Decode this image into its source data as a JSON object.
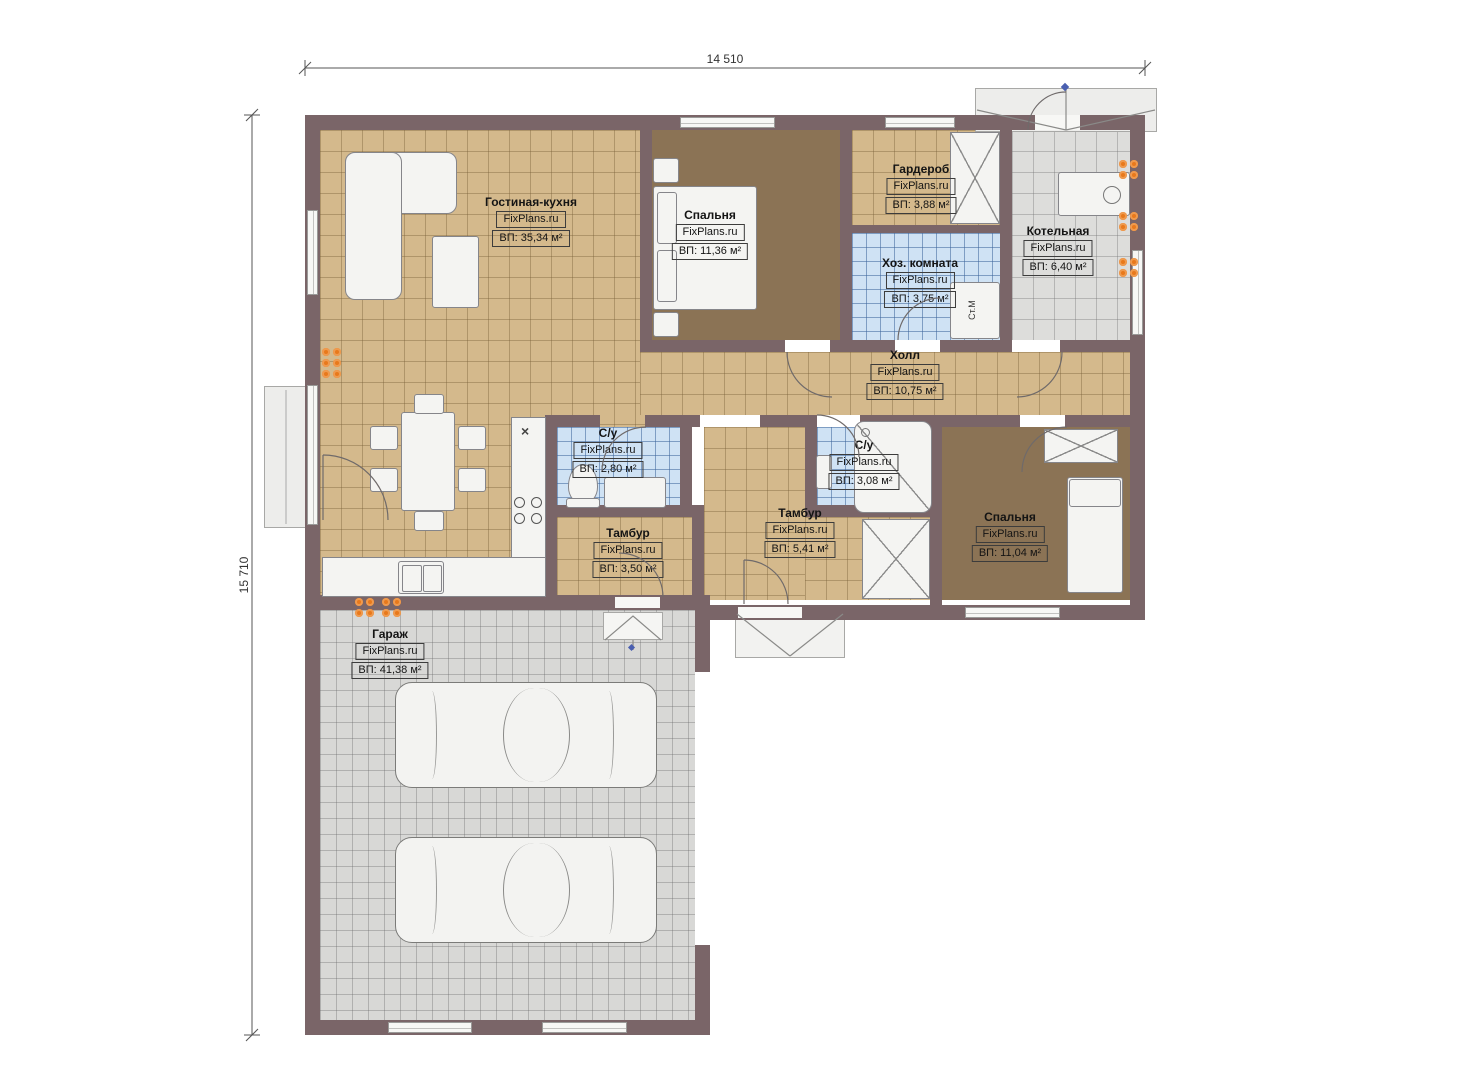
{
  "dimensions": {
    "width_label": "14 510",
    "height_label": "15 710"
  },
  "brand": "FixPlans.ru",
  "rooms": [
    {
      "name": "Гостиная-кухня",
      "brand": "FixPlans.ru",
      "area": "ВП: 35,34 м²"
    },
    {
      "name": "Спальня",
      "brand": "FixPlans.ru",
      "area": "ВП: 11,36 м²"
    },
    {
      "name": "Гардероб",
      "brand": "FixPlans.ru",
      "area": "ВП: 3,88 м²"
    },
    {
      "name": "Хоз. комната",
      "brand": "FixPlans.ru",
      "area": "ВП: 3,75 м²"
    },
    {
      "name": "Котельная",
      "brand": "FixPlans.ru",
      "area": "ВП: 6,40 м²"
    },
    {
      "name": "Холл",
      "brand": "FixPlans.ru",
      "area": "ВП: 10,75 м²"
    },
    {
      "name": "С/у",
      "brand": "FixPlans.ru",
      "area": "ВП: 2,80 м²"
    },
    {
      "name": "С/у",
      "brand": "FixPlans.ru",
      "area": "ВП: 3,08 м²"
    },
    {
      "name": "Тамбур",
      "brand": "FixPlans.ru",
      "area": "ВП: 3,50 м²"
    },
    {
      "name": "Тамбур",
      "brand": "FixPlans.ru",
      "area": "ВП: 5,41 м²"
    },
    {
      "name": "Спальня",
      "brand": "FixPlans.ru",
      "area": "ВП: 11,04 м²"
    },
    {
      "name": "Гараж",
      "brand": "FixPlans.ru",
      "area": "ВП: 41,38 м²"
    }
  ],
  "labels": {
    "washing_machine": "Ст.М",
    "hob_marker": "×"
  },
  "colors": {
    "wall": "#7a6568",
    "floor_tan": "#d4b98c",
    "floor_brown": "#8b7355",
    "floor_blue": "#cfe2f4",
    "floor_gray": "#dddddb",
    "radiator": "#e8791c",
    "marker_blue": "#4a5fb0"
  }
}
